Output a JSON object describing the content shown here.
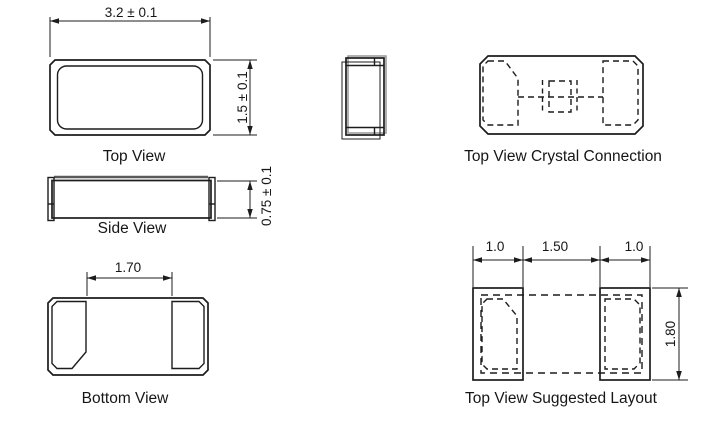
{
  "drawing": {
    "background_color": "#ffffff",
    "line_color": "#1c1c1c",
    "lid_gray_color": "#5a5a5a",
    "shadow_gray_color": "#979797",
    "views": {
      "top": {
        "label": "Top View",
        "width_dim": "3.2 ± 0.1",
        "height_dim": "1.5 ± 0.1"
      },
      "side": {
        "label": "Side View",
        "height_dim": "0.75 ± 0.1"
      },
      "bottom": {
        "label": "Bottom View",
        "pad_gap_dim": "1.70"
      },
      "crystal_connection": {
        "label": "Top View Crystal Connection"
      },
      "suggested_layout": {
        "label": "Top View Suggested Layout",
        "left_pad_width_dim": "1.0",
        "pad_gap_dim": "1.50",
        "right_pad_width_dim": "1.0",
        "height_dim": "1.80"
      }
    }
  }
}
